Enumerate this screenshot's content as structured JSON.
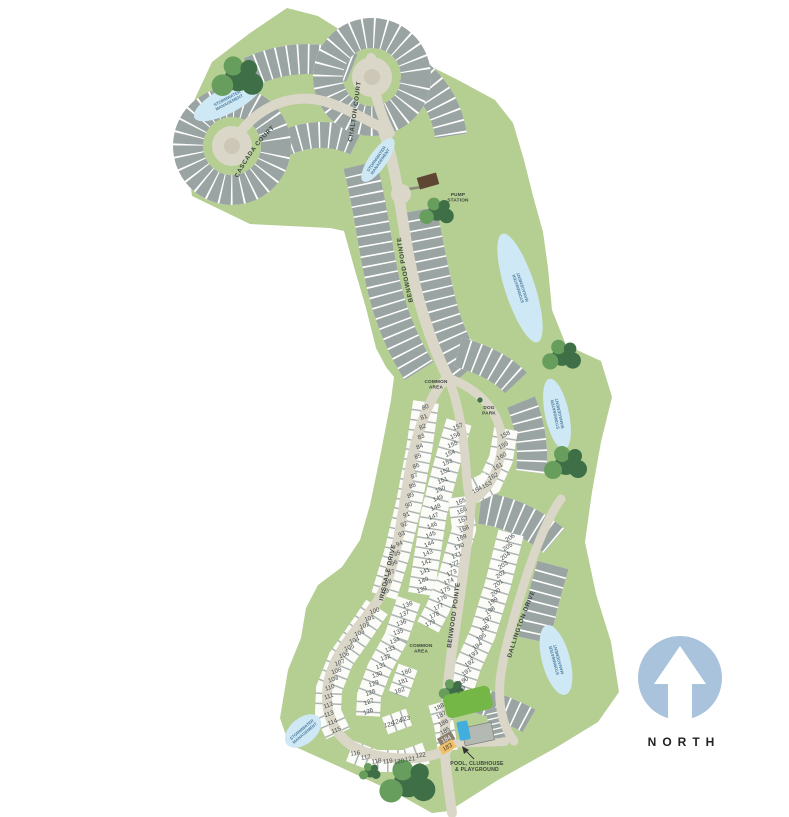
{
  "north_label": "NORTH",
  "streets": {
    "cascada": "CASCADA COURT",
    "chalton": "CHALTON COURT",
    "benwood_upper": "BENWOOD POINTE",
    "irisdale": "IRISDALE DRIVE",
    "benwood_lower": "BENWOOD POINTE",
    "dallington": "DALLINGTON DRIVE"
  },
  "labels": {
    "common_area_upper": [
      "COMMON",
      "AREA"
    ],
    "dog_park": [
      "DOG",
      "PARK"
    ],
    "common_area_lower": [
      "COMMON",
      "AREA"
    ],
    "pump_station": [
      "PUMP",
      "STATION"
    ],
    "pool": [
      "POOL, CLUBHOUSE",
      "& PLAYGROUND"
    ],
    "stormwater": [
      "STORMWATER",
      "MANAGEMENT"
    ]
  },
  "lots": {
    "colA": [
      80,
      81,
      82,
      83,
      84,
      85,
      86,
      87,
      88,
      89,
      90,
      91,
      92,
      93,
      94,
      95,
      96,
      97,
      98,
      99
    ],
    "colA2": [
      100,
      101,
      102,
      103,
      104,
      105,
      106,
      107,
      108,
      109,
      110,
      111,
      112,
      113,
      114,
      115
    ],
    "colBottom": [
      116,
      117,
      118,
      119,
      120,
      121,
      122
    ],
    "colC": [
      157,
      156,
      155,
      154,
      153,
      152,
      151,
      150,
      149,
      148,
      147,
      146,
      145,
      144,
      143,
      142,
      141,
      140,
      139
    ],
    "colD": [
      138,
      137,
      136,
      135,
      134,
      133,
      132,
      131,
      130,
      129,
      128,
      127,
      126
    ],
    "colD2": [
      125,
      124,
      123
    ],
    "colE": [
      158,
      159,
      160,
      161,
      162,
      163,
      164
    ],
    "colF": [
      165,
      166,
      167,
      168,
      169,
      170,
      171,
      172,
      173,
      174,
      175,
      176,
      177,
      178,
      179
    ],
    "colG": [
      180,
      181,
      182
    ],
    "colH": [
      188,
      187,
      186,
      185,
      184,
      183
    ],
    "colI": [
      206,
      205,
      204,
      203,
      202,
      201,
      200,
      199,
      198,
      197,
      196,
      195,
      194,
      193,
      192,
      191,
      190,
      189
    ]
  },
  "highlighted_lots": {
    "183": {
      "color": "#f0c169",
      "text": "#4a4538"
    },
    "184": {
      "color": "#8b7f70",
      "text": "#f7f5ef"
    }
  },
  "colors": {
    "land": "#b5ce92",
    "road": "#dbd7c8",
    "road_island": "#ccc7b6",
    "lot_gray": "#9aa4a2",
    "lot_line": "#adb5b2",
    "lot_white": "#fbfbf7",
    "number": "#474c4f",
    "pond": "#cfe8f5",
    "pond_text": "#4e7f9f",
    "tree_dark": "#3e6f46",
    "tree_light": "#679e5e",
    "street_text": "#3c463f",
    "label_text": "#3a433c",
    "north_circle": "#a9c3dd",
    "north_text": "#222222",
    "pump": "#5f4632",
    "pool": "#41aede",
    "playground": "#74b747",
    "clubhouse": "#b4b9b4"
  }
}
